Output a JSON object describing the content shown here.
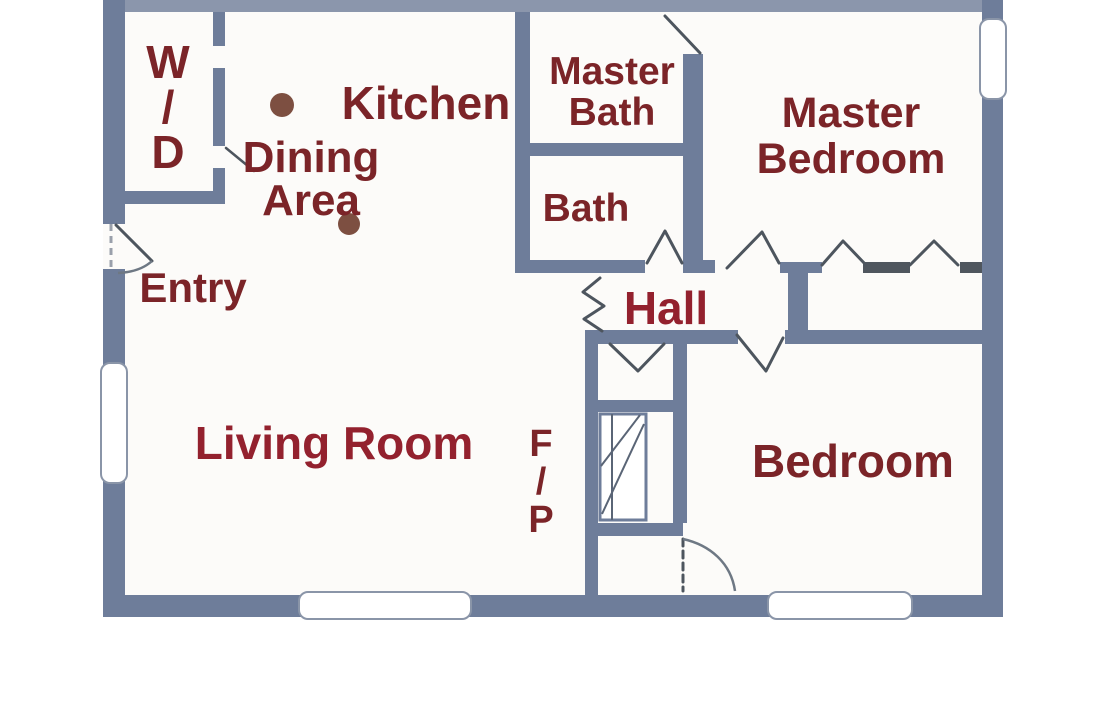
{
  "plan_type": "floor plan",
  "colors": {
    "wall": "#6e7d9a",
    "wall_light": "#8b96ac",
    "wall_dark": "#4f565e",
    "door_line": "#4d555e",
    "arc_line": "#6e7884",
    "window_border": "#8a95a8",
    "window_fill": "#ffffff",
    "floor": "#fcfbf9",
    "label_text": "#7b2428",
    "label_accent": "#93212e",
    "dot": "#7d4f41"
  },
  "rooms": {
    "wd": {
      "label": "W\n/\nD"
    },
    "kitchen": {
      "label": "Kitchen"
    },
    "dining": {
      "label": "Dining\nArea"
    },
    "master_bath": {
      "label": "Master\nBath"
    },
    "bath": {
      "label": "Bath"
    },
    "master_bedroom": {
      "label": "Master\nBedroom"
    },
    "entry": {
      "label": "Entry"
    },
    "hall": {
      "label": "Hall"
    },
    "living_room": {
      "label": "Living Room"
    },
    "fireplace": {
      "label": "F\n/\nP"
    },
    "bedroom": {
      "label": "Bedroom"
    }
  }
}
